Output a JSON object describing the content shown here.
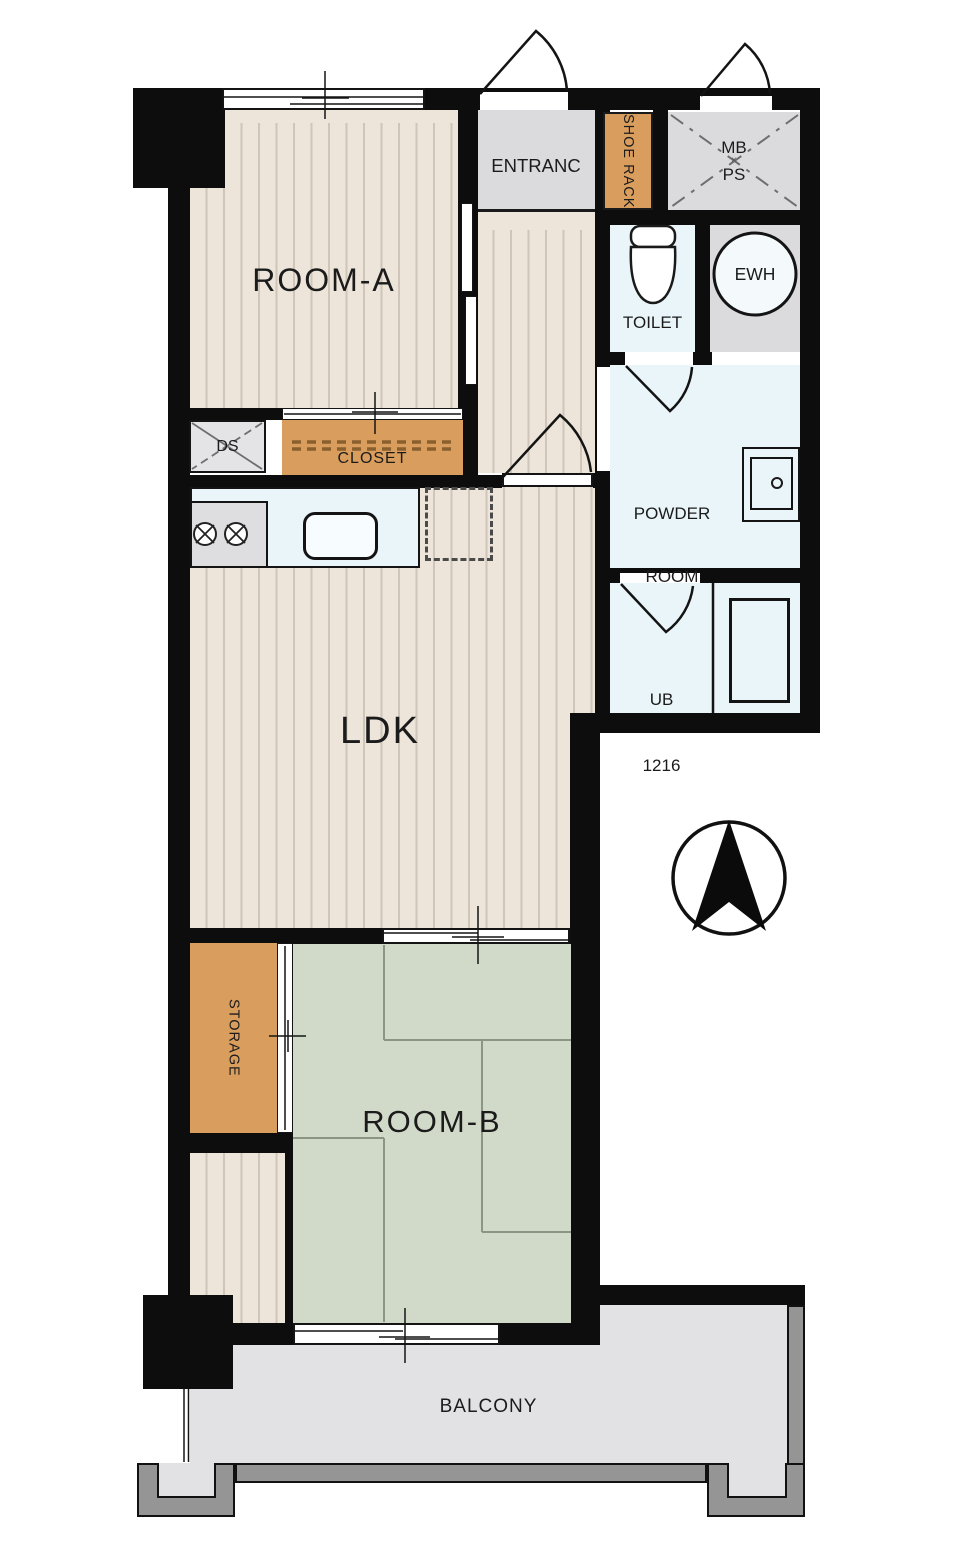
{
  "rooms": {
    "room_a": "ROOM-A",
    "ldk": "LDK",
    "room_b": "ROOM-B",
    "entrance": "ENTRANC",
    "shoe_rack": "SHOE RACK",
    "mb": "MB",
    "mb_ps_mark": "×",
    "ps": "PS",
    "toilet": "TOILET",
    "ewh": "EWH",
    "powder_line1": "POWDER",
    "powder_line2": "ROOM",
    "ub_line1": "UB",
    "ub_line2": "1216",
    "closet": "CLOSET",
    "ds": "DS",
    "storage": "STORAGE",
    "balcony": "BALCONY"
  },
  "icons": {
    "north_arrow": "compass-north-arrow",
    "toilet_fixture": "toilet-icon",
    "bathtub": "bathtub-icon",
    "stove": "two-burner-stove-icon",
    "kitchen_sink": "sink-icon",
    "powder_sink": "wash-basin-icon"
  },
  "colors": {
    "wall": "#0d0d0d",
    "wood_floor": "#EDE5DA",
    "wood_stripe": "#CFC5B9",
    "tatami_green": "#D1DAC9",
    "tatami_line": "#8A9584",
    "storage_accent": "#D99E5E",
    "service_gray": "#DBDBDD",
    "wet_area_blue": "#EAF5F9",
    "balcony_floor": "#E2E2E4",
    "railing_gray": "#959595"
  }
}
